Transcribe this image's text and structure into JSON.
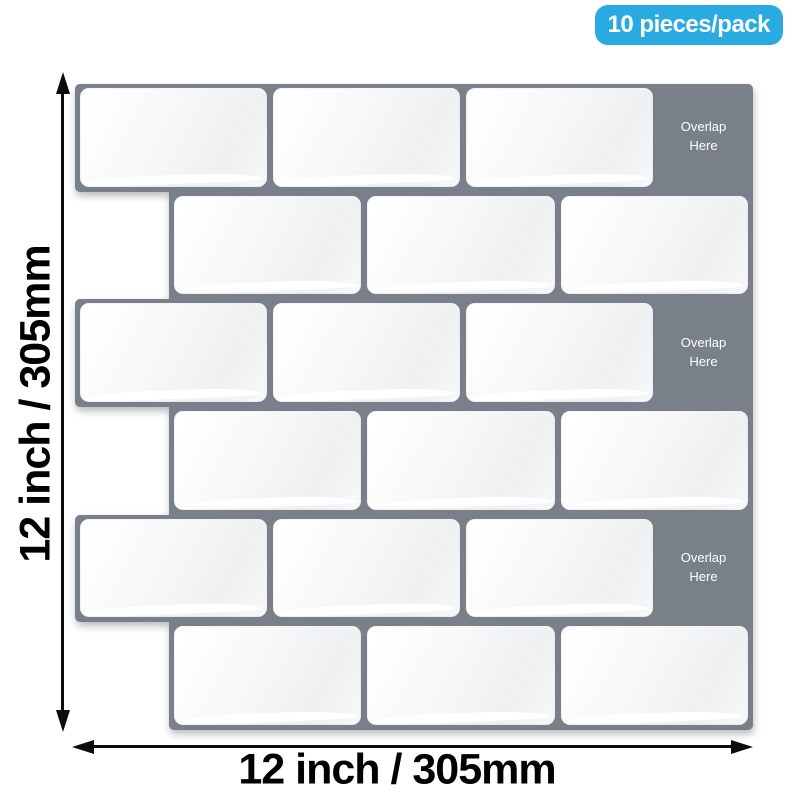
{
  "badge": {
    "label": "10 pieces/pack"
  },
  "dimension_labels": {
    "vertical": "12 inch / 305mm",
    "horizontal": "12 inch / 305mm"
  },
  "sheet": {
    "overlap_label": "Overlap Here",
    "rows": [
      {
        "tiles": 3,
        "indented": false,
        "overlap": true
      },
      {
        "tiles": 3,
        "indented": true,
        "overlap": false
      },
      {
        "tiles": 3,
        "indented": false,
        "overlap": true
      },
      {
        "tiles": 3,
        "indented": true,
        "overlap": false
      },
      {
        "tiles": 3,
        "indented": false,
        "overlap": true
      },
      {
        "tiles": 3,
        "indented": true,
        "overlap": false
      }
    ]
  },
  "colors": {
    "badge_bg": "#29abe2",
    "badge_text": "#ffffff",
    "sheet_gray": "#798089",
    "tile_white": "#ffffff",
    "overlap_text": "#ffffff",
    "dimension_text": "#000000"
  }
}
